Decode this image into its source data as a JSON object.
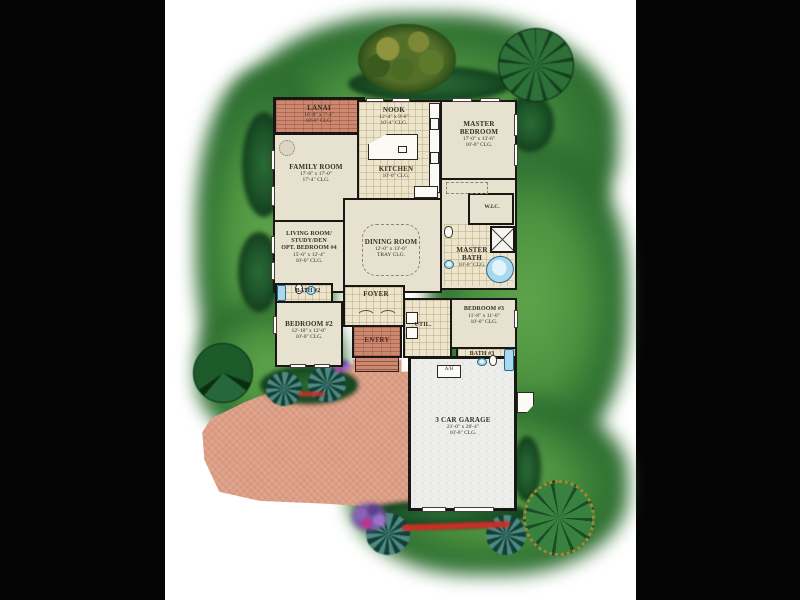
{
  "scene": {
    "description": "Rendered color site plan of a single-family home floor plan on landscaped lot",
    "background_color": "#000000",
    "paper_color": "#ffffff",
    "grass_color": "#4c923f",
    "driveway_color": "#e2a78f",
    "wall_color": "#191714"
  },
  "rooms": {
    "lanai": {
      "name": "LANAI",
      "dims": "18'-8\" x 7'-4\"",
      "clg": "10'-0\" CLG."
    },
    "nook": {
      "name": "NOOK",
      "dims": "12'-4\" x 9'-6\"",
      "clg": "10'-4\" CLG."
    },
    "master_bedroom": {
      "name": "MASTER BEDROOM",
      "dims": "17'-0\" x 13'-6\"",
      "clg": "10'-0\" CLG."
    },
    "family_room": {
      "name": "FAMILY ROOM",
      "dims": "17'-8\" x 17'-0\"",
      "clg": "17'-4\" CLG."
    },
    "kitchen": {
      "name": "KITCHEN",
      "clg": "10'-0\" CLG."
    },
    "living_room": {
      "name1": "LIVING ROOM/",
      "name2": "STUDY/DEN",
      "name3": "OPT. BEDROOM #4",
      "dims": "15'-6\" x 12'-4\"",
      "clg": "10'-0\" CLG."
    },
    "dining_room": {
      "name": "DINING ROOM",
      "dims": "12'-0\" x 13'-0\"",
      "clg": "TRAY CLG."
    },
    "master_bath": {
      "name": "MASTER BATH",
      "clg": "10'-0\" CLG."
    },
    "wic": {
      "name": "W.I.C."
    },
    "foyer": {
      "name": "FOYER"
    },
    "bath2": {
      "name": "BATH #2"
    },
    "bedroom2": {
      "name": "BEDROOM #2",
      "dims": "12'-10\" x 12'-0\"",
      "clg": "10'-0\" CLG."
    },
    "entry": {
      "name": "ENTRY"
    },
    "util": {
      "name": "UTIL."
    },
    "bedroom3": {
      "name": "BEDROOM #3",
      "dims": "11'-8\" x 11'-0\"",
      "clg": "10'-0\" CLG."
    },
    "bath3": {
      "name": "BATH #3"
    },
    "garage": {
      "name": "3 CAR GARAGE",
      "dims": "21'-0\" x 28'-4\"",
      "clg": "10'-0\" CLG."
    },
    "ah": {
      "name": "A/H"
    }
  }
}
